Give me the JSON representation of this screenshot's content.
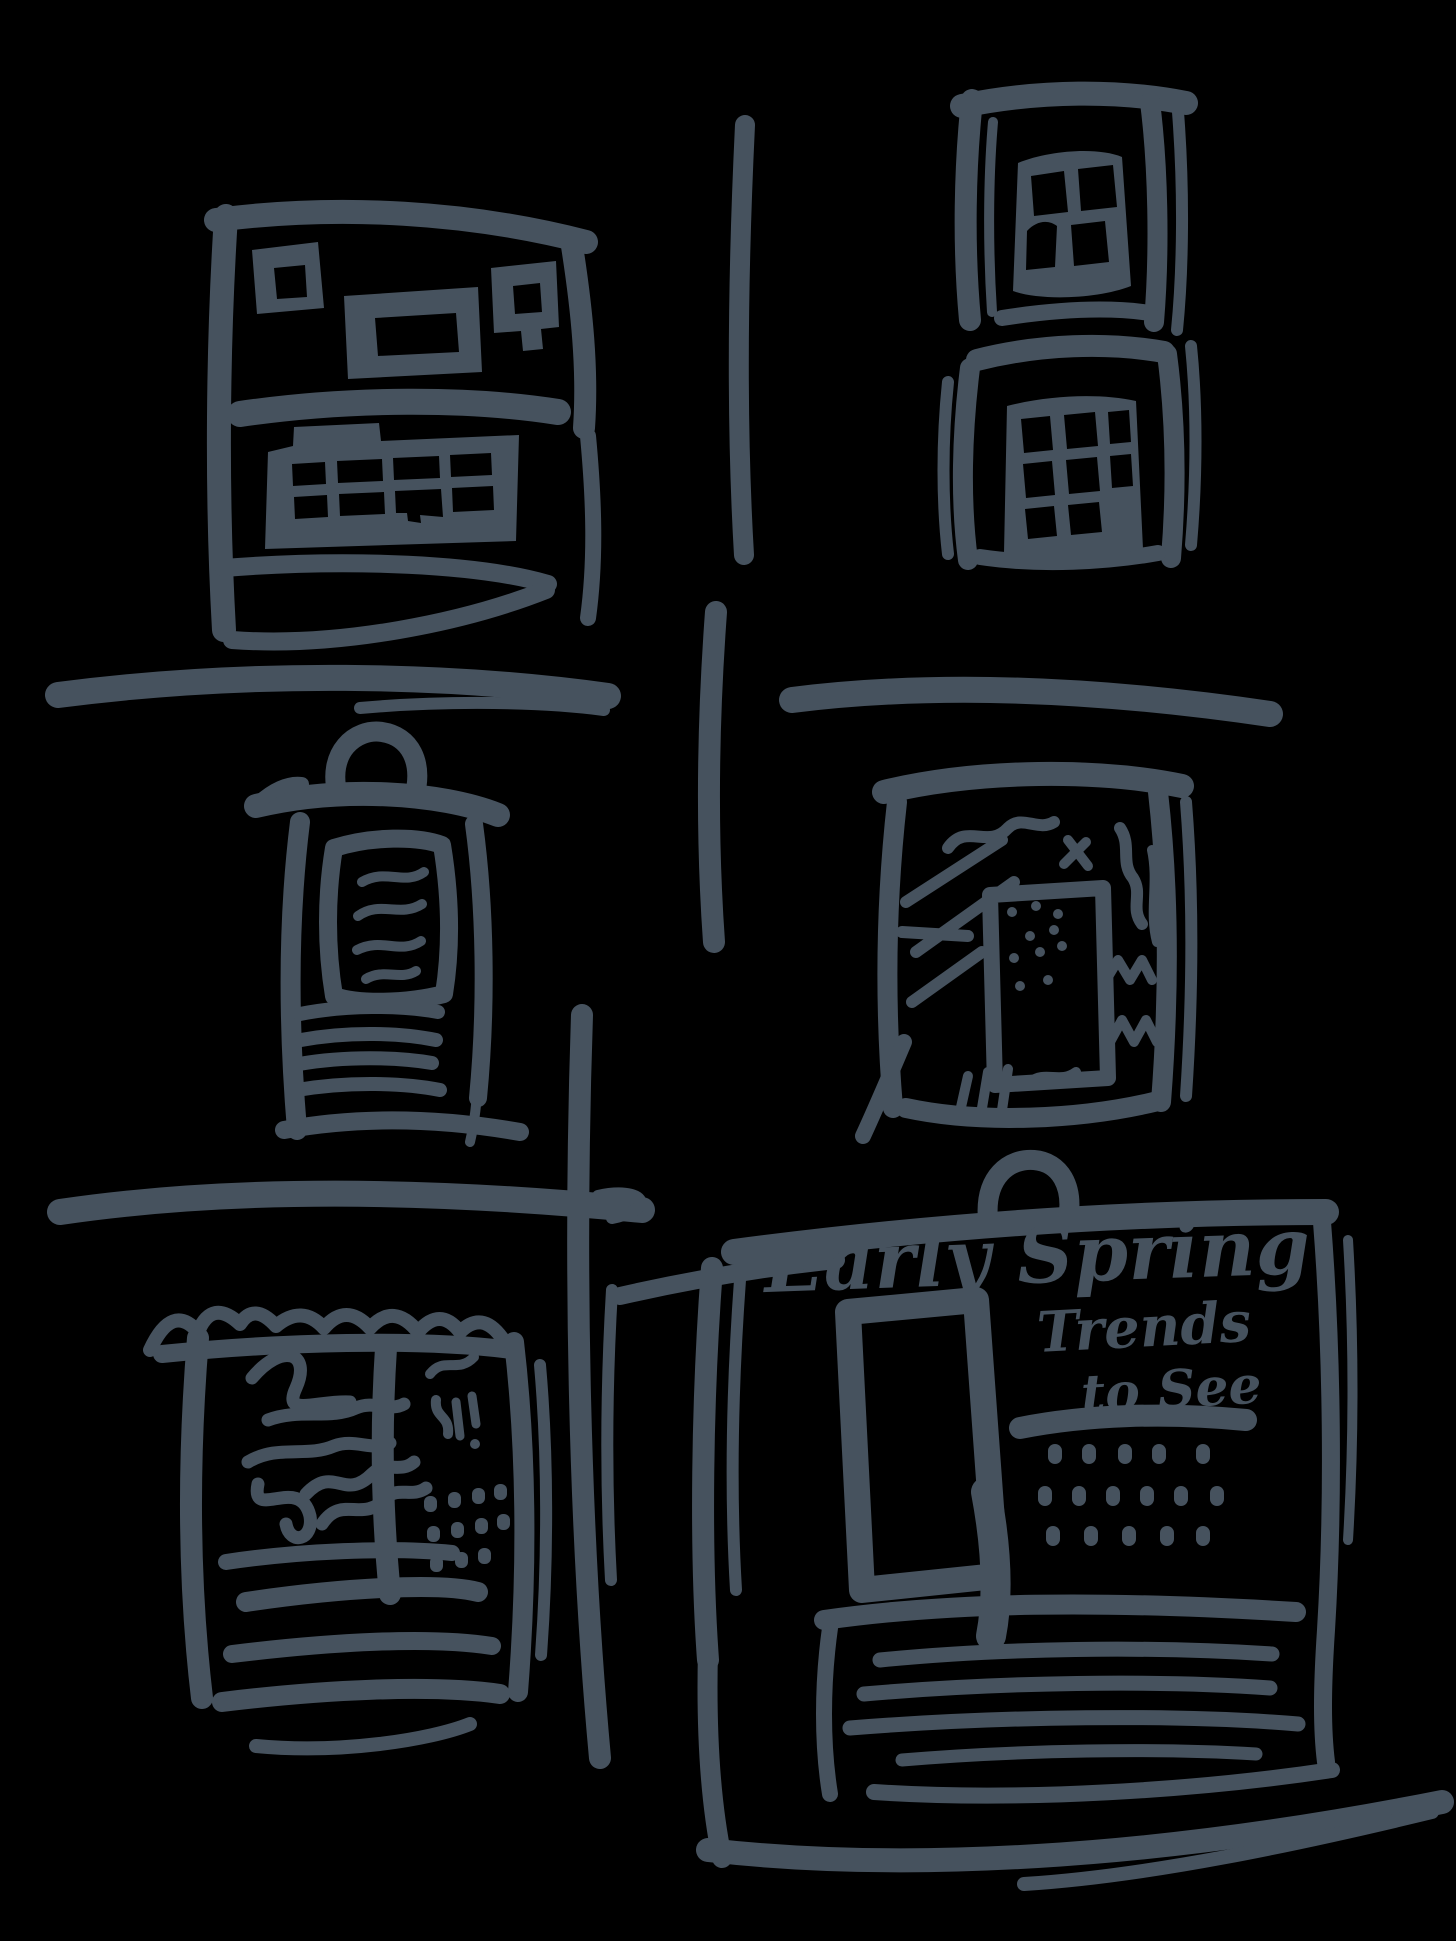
{
  "colors": {
    "ink": "#46525E",
    "background": "#000000"
  },
  "handwriting": {
    "line1": "Early Spring",
    "line2": "Trends",
    "line3": "to See"
  }
}
